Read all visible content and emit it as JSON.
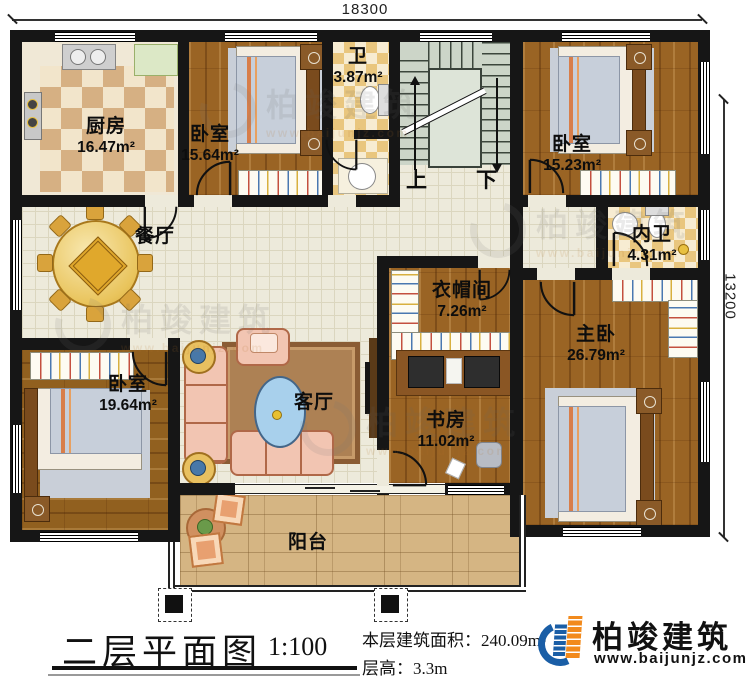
{
  "dimensions": {
    "top": "18300",
    "right": "13200"
  },
  "rooms": {
    "kitchen": {
      "name": "厨房",
      "area": "16.47m²"
    },
    "bedroom1": {
      "name": "卧室",
      "area": "15.64m²"
    },
    "bath": {
      "name": "卫",
      "area": "3.87m²"
    },
    "bedroom2": {
      "name": "卧室",
      "area": "15.23m²"
    },
    "inner_bath": {
      "name": "内卫",
      "area": "4.31m²"
    },
    "dining": {
      "name": "餐厅",
      "area": ""
    },
    "cloakroom": {
      "name": "衣帽间",
      "area": "7.26m²"
    },
    "master": {
      "name": "主卧",
      "area": "26.79m²"
    },
    "bedroom3": {
      "name": "卧室",
      "area": "19.64m²"
    },
    "living": {
      "name": "客厅",
      "area": ""
    },
    "study": {
      "name": "书房",
      "area": "11.02m²"
    },
    "balcony": {
      "name": "阳台",
      "area": ""
    }
  },
  "stairs": {
    "up": "上",
    "down": "下"
  },
  "footer": {
    "title": "二层平面图",
    "scale": "1:100",
    "area_label": "本层建筑面积：240.09m²",
    "floor_height": "层高：3.3m"
  },
  "brand": {
    "name": "柏竣建筑",
    "url": "www.baijunjz.com"
  }
}
